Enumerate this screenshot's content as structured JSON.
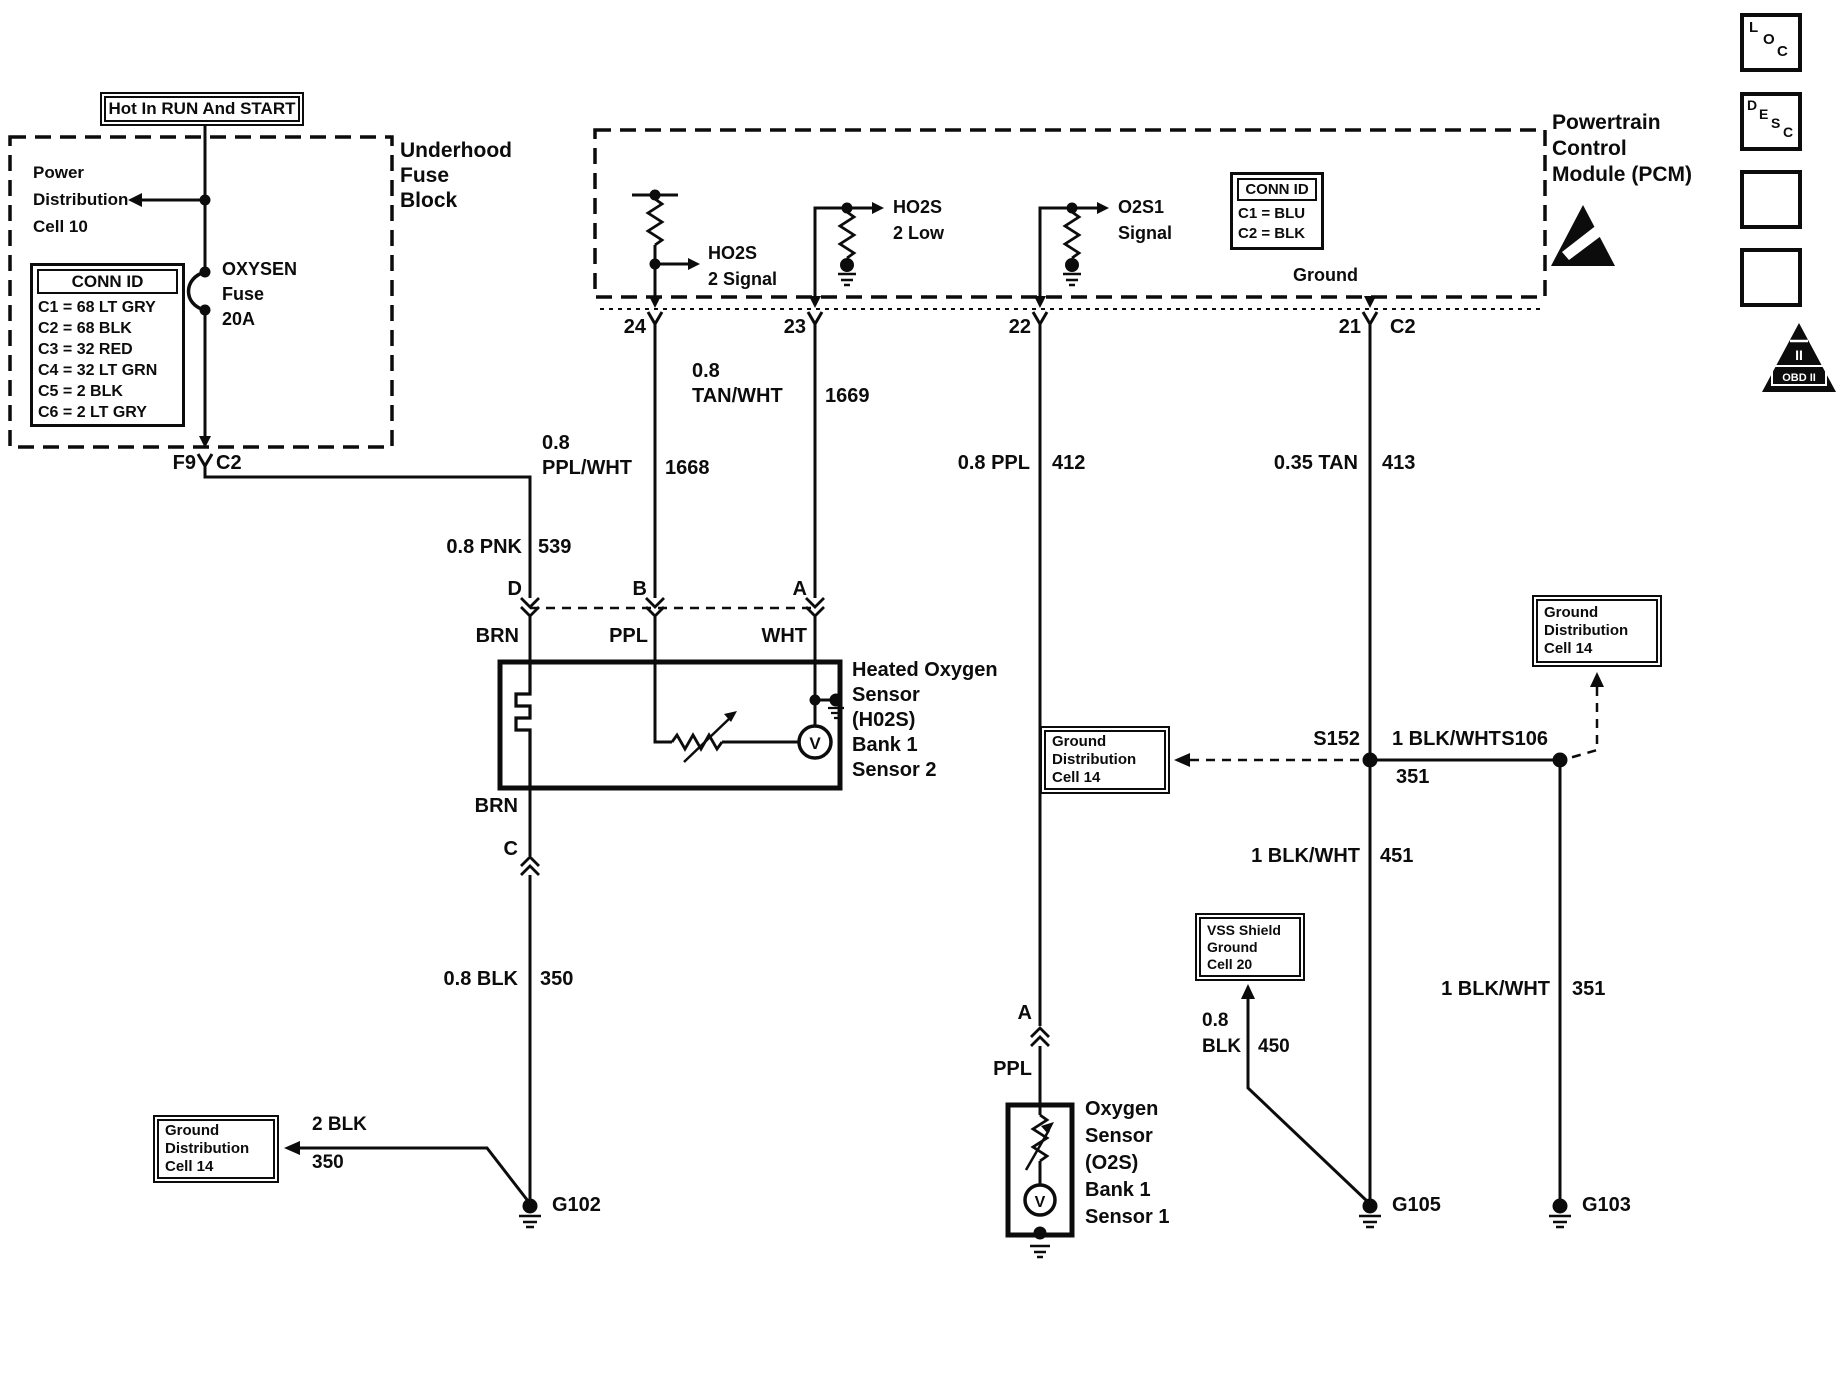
{
  "colors": {
    "ink": "#0c0c0c",
    "paper": "#ffffff"
  },
  "title_box": "Hot In RUN And START",
  "underhood": [
    "Underhood",
    "Fuse",
    "Block"
  ],
  "power_dist": [
    "Power",
    "Distribution",
    "Cell 10"
  ],
  "fuse": [
    "OXYSEN",
    "Fuse",
    "20A"
  ],
  "conn_left": {
    "title": "CONN ID",
    "rows": [
      "C1 = 68 LT GRY",
      "C2 = 68 BLK",
      "C3 = 32 RED",
      "C4 = 32 LT GRN",
      "C5 = 2 BLK",
      "C6 = 2 LT GRY"
    ]
  },
  "f9": {
    "pin": "F9",
    "conn": "C2"
  },
  "pcm": {
    "label": [
      "Powertrain",
      "Control",
      "Module (PCM)"
    ],
    "ground": "Ground",
    "conn": {
      "title": "CONN ID",
      "rows": [
        "C1 = BLU",
        "C2 = BLK"
      ]
    },
    "signals": {
      "ho2s_signal": [
        "HO2S",
        "2 Signal"
      ],
      "ho2s_low": [
        "HO2S",
        "2 Low"
      ],
      "o2s1_signal": [
        "O2S1",
        "Signal"
      ]
    },
    "pins": {
      "p24": "24",
      "p23": "23",
      "p22": "22",
      "p21": "21",
      "c2": "C2"
    }
  },
  "wires": {
    "pnk539": {
      "name": "0.8 PNK",
      "num": "539"
    },
    "pplwht1668": {
      "size": "0.8",
      "name": "PPL/WHT",
      "num": "1668"
    },
    "tanwht1669": {
      "size": "0.8",
      "name": "TAN/WHT",
      "num": "1669"
    },
    "ppl412": {
      "name": "0.8 PPL",
      "num": "412"
    },
    "tan413": {
      "name": "0.35 TAN",
      "num": "413"
    },
    "blk350": {
      "name": "0.8 BLK",
      "num": "350"
    },
    "blk2_350": {
      "name": "2 BLK",
      "num": "350"
    },
    "blkwht451": {
      "name": "1 BLK/WHT",
      "num": "451"
    },
    "blkwht351_h": {
      "name": "1 BLK/WHT",
      "num": "351"
    },
    "blkwht351_v": {
      "name": "1 BLK/WHT",
      "num": "351"
    },
    "blk450": {
      "size": "0.8",
      "name": "BLK",
      "num": "450"
    },
    "brn_top": "BRN",
    "ppl": "PPL",
    "wht": "WHT",
    "brn_bottom": "BRN",
    "conn_d": "D",
    "conn_b": "B",
    "conn_a": "A",
    "conn_c": "C",
    "o2s_a": "A",
    "o2s_ppl": "PPL"
  },
  "sensors": {
    "ho2s": [
      "Heated Oxygen",
      "Sensor",
      "(H02S)",
      "Bank 1",
      "Sensor 2"
    ],
    "o2s": [
      "Oxygen",
      "Sensor",
      "(O2S)",
      "Bank 1",
      "Sensor 1"
    ],
    "v": "V"
  },
  "grounds": {
    "g102": "G102",
    "g105": "G105",
    "g103": "G103"
  },
  "splices": {
    "s152": "S152",
    "s106": "S106"
  },
  "ref_boxes": {
    "ground_dist_left": [
      "Ground",
      "Distribution",
      "Cell 14"
    ],
    "ground_dist_mid": [
      "Ground",
      "Distribution",
      "Cell 14"
    ],
    "ground_dist_right": [
      "Ground",
      "Distribution",
      "Cell 14"
    ],
    "vss": [
      "VSS Shield",
      "Ground",
      "Cell 20"
    ]
  },
  "icons": {
    "loc": [
      "L",
      "O",
      "C"
    ],
    "desc": [
      "D",
      "E",
      "S",
      "C"
    ],
    "obd": {
      "ii": "II",
      "label": "OBD II"
    }
  }
}
